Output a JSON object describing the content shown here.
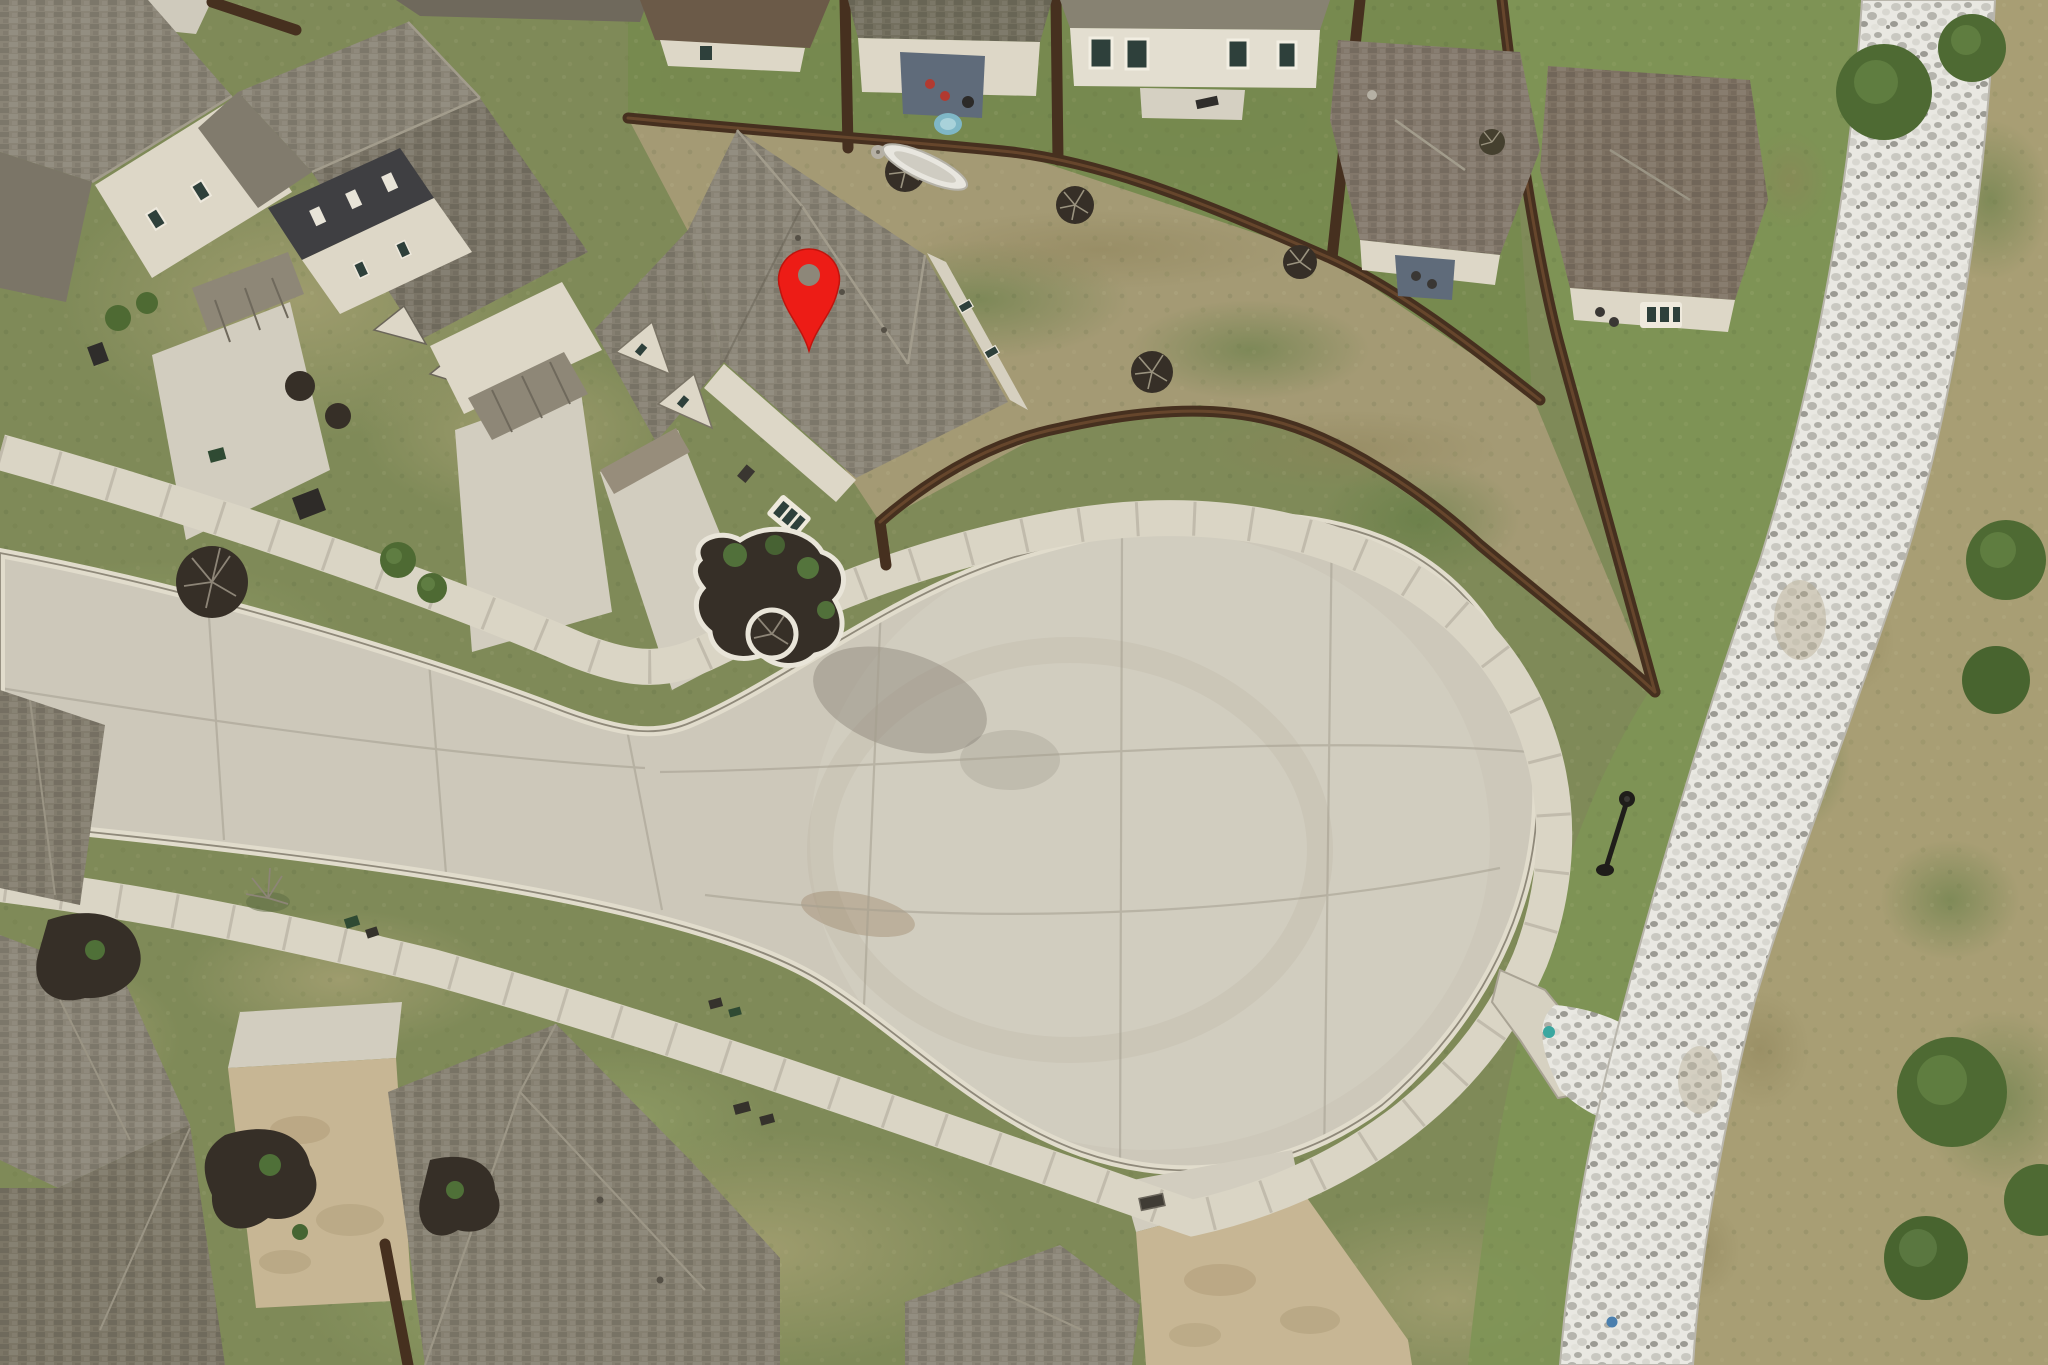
{
  "scene": {
    "description": "aerial-drone-photo-of-residential-cul-de-sac-with-location-pin",
    "marker": {
      "x": 809,
      "y": 277,
      "transform": "translate(809,277)",
      "color": "#ed1c16",
      "edge_color": "#c0140d",
      "hole_color": "#8d8779"
    }
  },
  "palette": {
    "grass_base": "#7f8a58",
    "lawn_bright": "#77894f",
    "mowed_strip": "#7e9355",
    "lawn_tan": "#a49a74",
    "field_tan": "#a89e74",
    "pavement": "#cdc8ba",
    "pavement_light": "#d6d1c3",
    "sidewalk": "#dad5c5",
    "curb_light": "#e1dccc",
    "curb_shadow": "#8f897a",
    "joint": "#a49e8f",
    "drive_concrete": "#d2cdbf",
    "drive_tan": "#c7b694",
    "rock_bg": "#e9e8e2",
    "fence": "#46301f",
    "fence_light": "#7c5535",
    "roof_gray": "#8a8476",
    "roof_dark": "#7b7567",
    "roof_brown": "#82776a",
    "wall_cream": "#ddd7c7",
    "wall_dark": "#3f3f42",
    "window_dark": "#2e403b",
    "mulch": "#362f27",
    "bed_border": "#e9e5d9",
    "bush_green": "#4e6a33",
    "patio_floor": "#5f6b7a",
    "pool_blue": "#7fb7c6",
    "chair_red": "#b23a30",
    "teal_marker": "#3aa7a0",
    "lamp_black": "#1f1d1a"
  }
}
